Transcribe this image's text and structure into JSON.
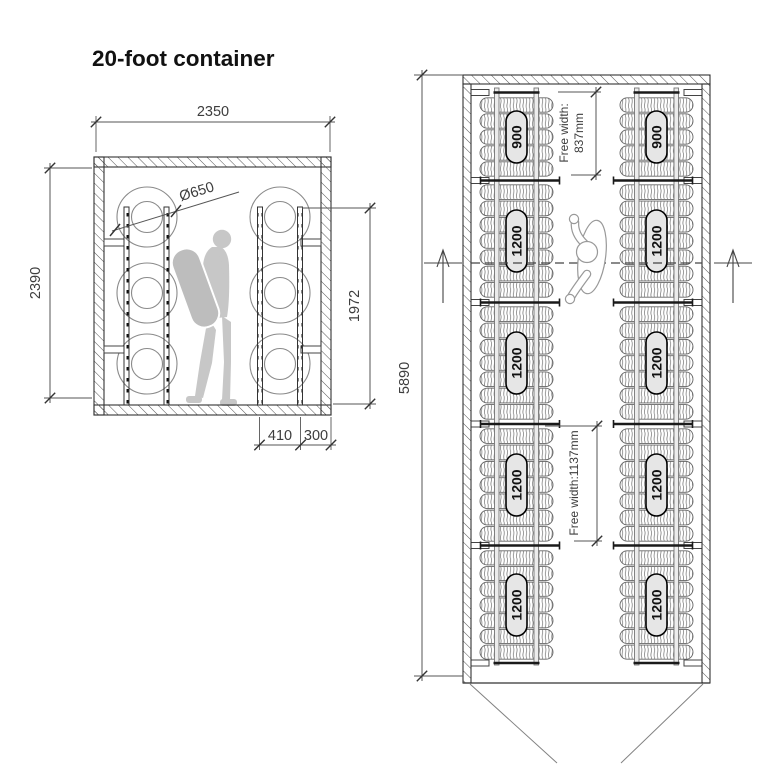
{
  "title": "20-foot container",
  "cross_section": {
    "width_dim": "2350",
    "height_dim": "2390",
    "tire_diameter": "Ø650",
    "rack_height_dim": "1972",
    "rack_depth_dim": "410",
    "wall_gap_dim": "300"
  },
  "plan": {
    "length_dim": "5890",
    "free_width_top": {
      "line1": "Free width:",
      "line2": "837mm"
    },
    "free_width_mid": "Free width:1137mm",
    "rows": [
      {
        "label": "900",
        "tires": 5
      },
      {
        "label": "1200",
        "tires": 7
      },
      {
        "label": "1200",
        "tires": 7
      },
      {
        "label": "1200",
        "tires": 7
      },
      {
        "label": "1200",
        "tires": 7
      }
    ]
  },
  "colors": {
    "line": "#3a3a3a",
    "dim_text": "#3d3d3d",
    "label_bg": "#e6e6e6",
    "silhouette": "#c7c7c7"
  }
}
